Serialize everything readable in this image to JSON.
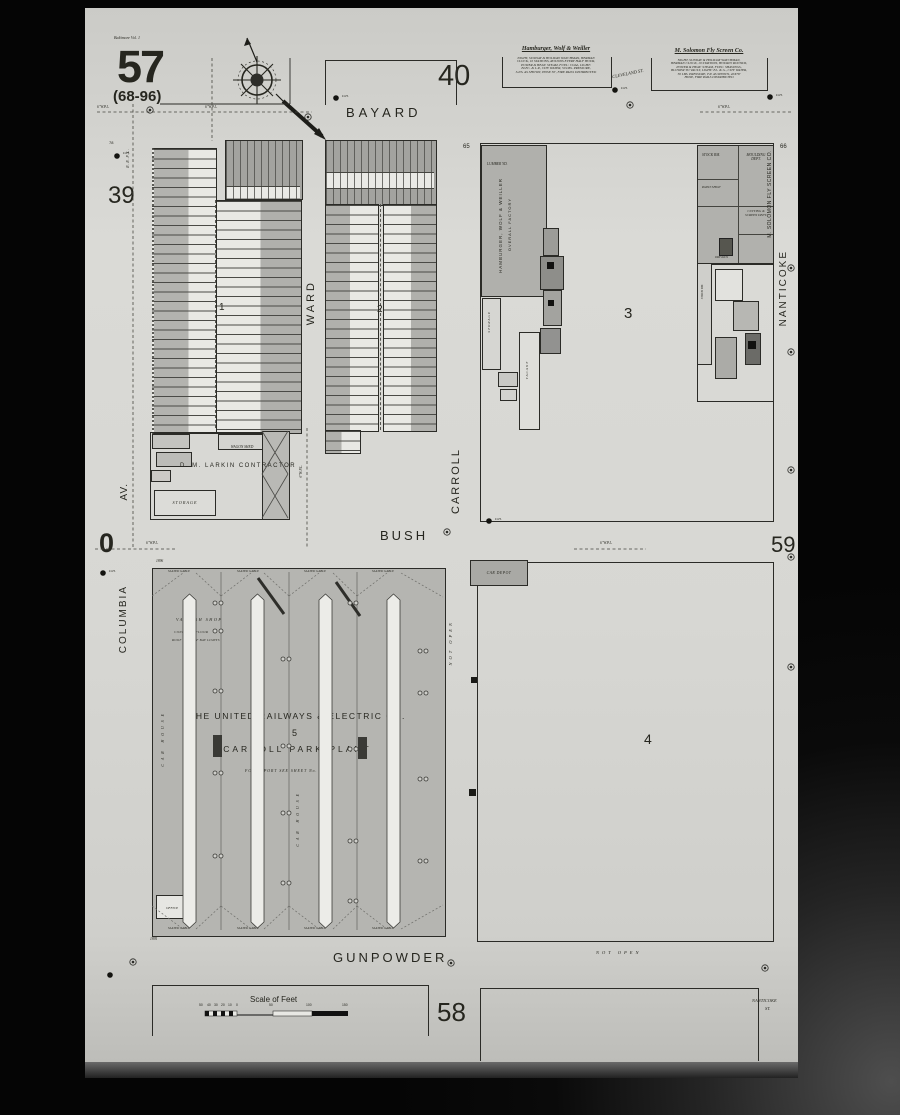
{
  "sheet": {
    "volume_note": "Baltimore Vol. 1",
    "number": "57",
    "range": "(68-96)"
  },
  "adjacent_sheets": {
    "top": "40",
    "left": "39",
    "left_bush": "0",
    "right_bush": "59",
    "bottom": "58"
  },
  "streets": {
    "bayard": "BAYARD",
    "ward": "WARD",
    "carroll": "CARROLL",
    "columbia": "COLUMBIA",
    "columbia_av": "AV.",
    "nanticoke": "NANTICOKE",
    "bush": "BUSH",
    "gunpowder": "GUNPOWDER"
  },
  "blocks": {
    "b1": "1",
    "b2": "2",
    "b3": "3",
    "b4": "4",
    "b5": "5"
  },
  "corner_numbers": {
    "c65": "65",
    "c66": "66",
    "n78": "78",
    "dim_top": "1896",
    "dim_bottom": "1895"
  },
  "businesses": {
    "hamburger": {
      "title": "Hamburger, Wolf & Weiller",
      "notes": [
        "NIGHT, SUNDAY & HOLIDAY WATCHMAN, HERMAN",
        "CLOCK, 10 STATIONS, ROUNDS EVERY HALF HOUR,",
        "POWER & HEAT: STEAM, FUEL: COAL, LIGHT:",
        "ELEC. & L.P., CITY WATER, 50 LBS. PRESSURE,",
        "S.P.S. AS SHOWN, HOSE 50', FIRE PAILS DISTRIBUTED"
      ]
    },
    "solomon": {
      "title": "M. Solomon Fly Screen Co.",
      "notes": [
        "NIGHT, SUNDAY & HOLIDAY WATCHMAN,",
        "HERMAN CLOCK, 10 STATIONS, HOURLY ROUNDS,",
        "POWER & HEAT: STEAM, FUEL: SHAVINGS,",
        "BLOWER TO VAULT, LIGHT: EL. & G., CITY WATER,",
        "50 LBS. PRESSURE, F.P. AS SHOWN, 40X78'",
        "HOSE, FIRE PAILS DISTRIBUTED"
      ]
    },
    "factory_label_1": "HAMBURGER, WOLF & WEILLER",
    "factory_label_2": "OVERALL FACTORY",
    "solomon_building_label": "M. SOLOMON FLY SCREEN CO.",
    "larkin": "D. M. LARKIN  CONTRACTOR",
    "united_line1": "THE UNITED RAILWAYS & ELECTRIC CO.",
    "united_line2": "CARROLL PARK PLANT",
    "united_note": "FOR REPORT SEE SHEET No. 58"
  },
  "labels": {
    "wagon_shed": "WAGON SHED",
    "storage": "STORAGE",
    "vacant": "VACANT",
    "lumber_yd": "LUMBER YD.",
    "stock_rm": "STOCK RM.",
    "moulding_dept": "MOULDING DEPT.",
    "cutting_dept": "CUTTING & SCREEN DEPT.",
    "paint_shop": "PAINT SHOP",
    "dry_kiln": "DRY KILN",
    "varnish_shop": "VARNISH SHOP",
    "concrete_floor": "CONCRETE FLOOR",
    "roof_note": "ROOF RAILS OF BAY LIGHTS",
    "car_depot": "CAR DEPOT",
    "office": "OFFICE",
    "car_house": "CAR HOUSE",
    "slated_gable": "SLATED GABLE",
    "not_open": "NOT OPEN",
    "cleveland_st": "CLEVELAND ST.",
    "nanticoke_st_line1": "NANTICOKE",
    "nanticoke_st_line2": "ST.",
    "pipe_label": "6''W.P.L.",
    "rr_pipe_label": "R.R.P.L.",
    "hydrant_label": "D.H."
  },
  "scale_bar": {
    "title": "Scale of Feet",
    "ticks": [
      "50",
      "40",
      "30",
      "20",
      "10",
      "0",
      "50",
      "100",
      "150"
    ]
  }
}
